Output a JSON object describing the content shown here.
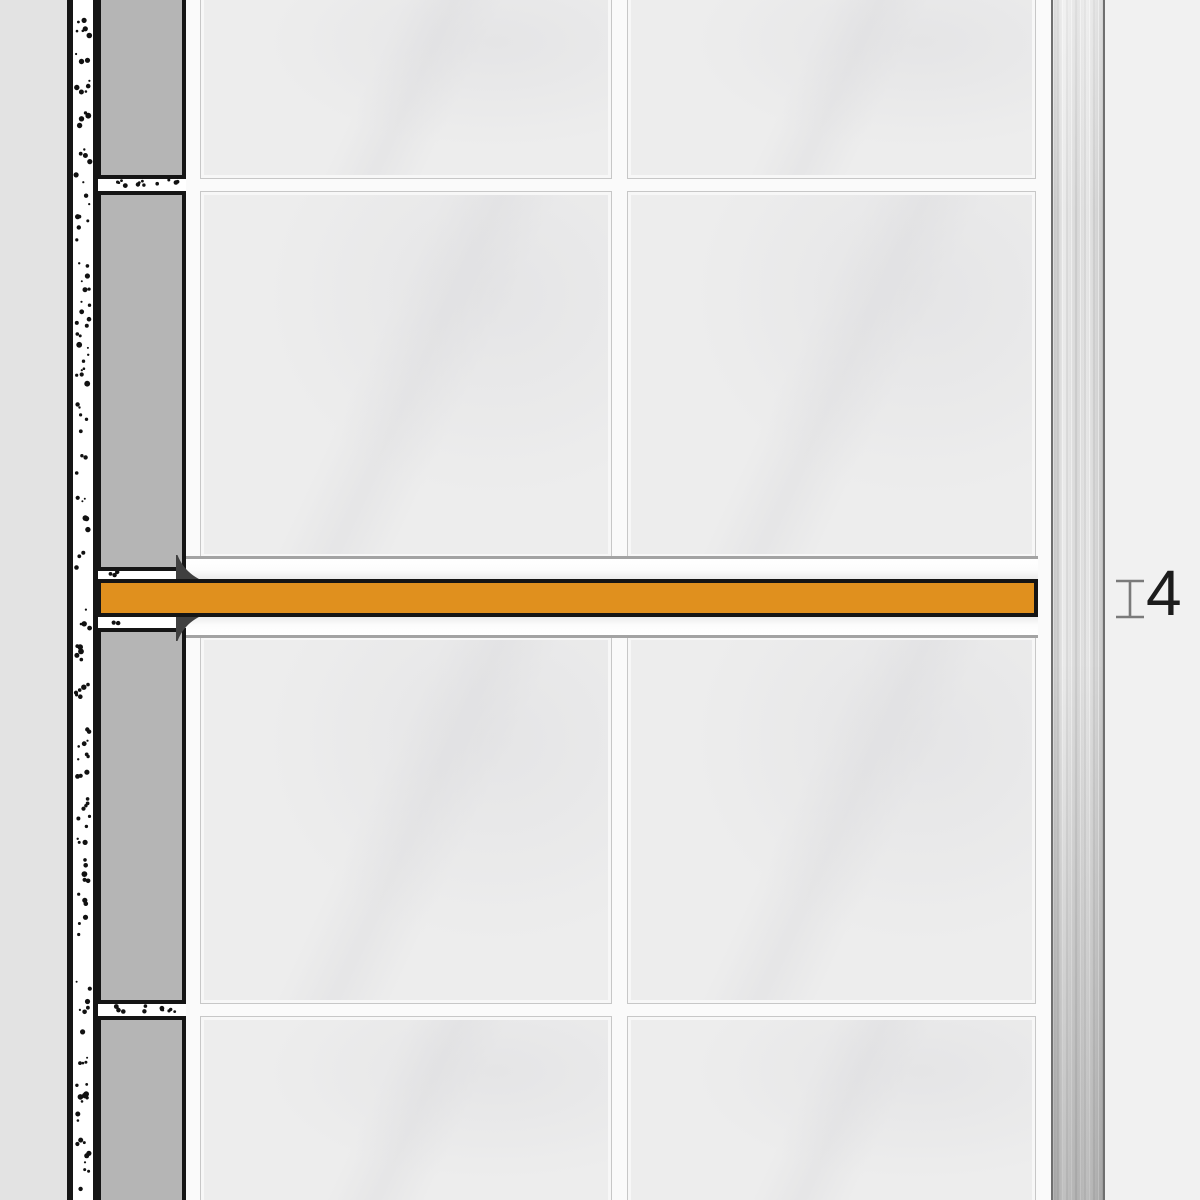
{
  "diagram": {
    "label": {
      "value": "4"
    },
    "icons": {
      "measure_marker": "height-measure-icon",
      "stipple": "adhesive-stipple-dots"
    },
    "colors": {
      "profile-orange": "#E0901E",
      "outline": "#151515",
      "tile-face": "#EDEDED",
      "grout": "#FAFAFA",
      "section-tile": "#B5B5B5",
      "wall": "#E3E3E3",
      "adhesive-bg": "#FFFFFF",
      "steel-edge": "#6F6F6F",
      "background": "#F1F1F1",
      "measure-gray": "#7A7A7A",
      "label-black": "#1C1C1C",
      "wedge-dark": "#404040",
      "band-white": "#FCFCFC",
      "tile-edge-line": "#A3A3A3"
    }
  }
}
